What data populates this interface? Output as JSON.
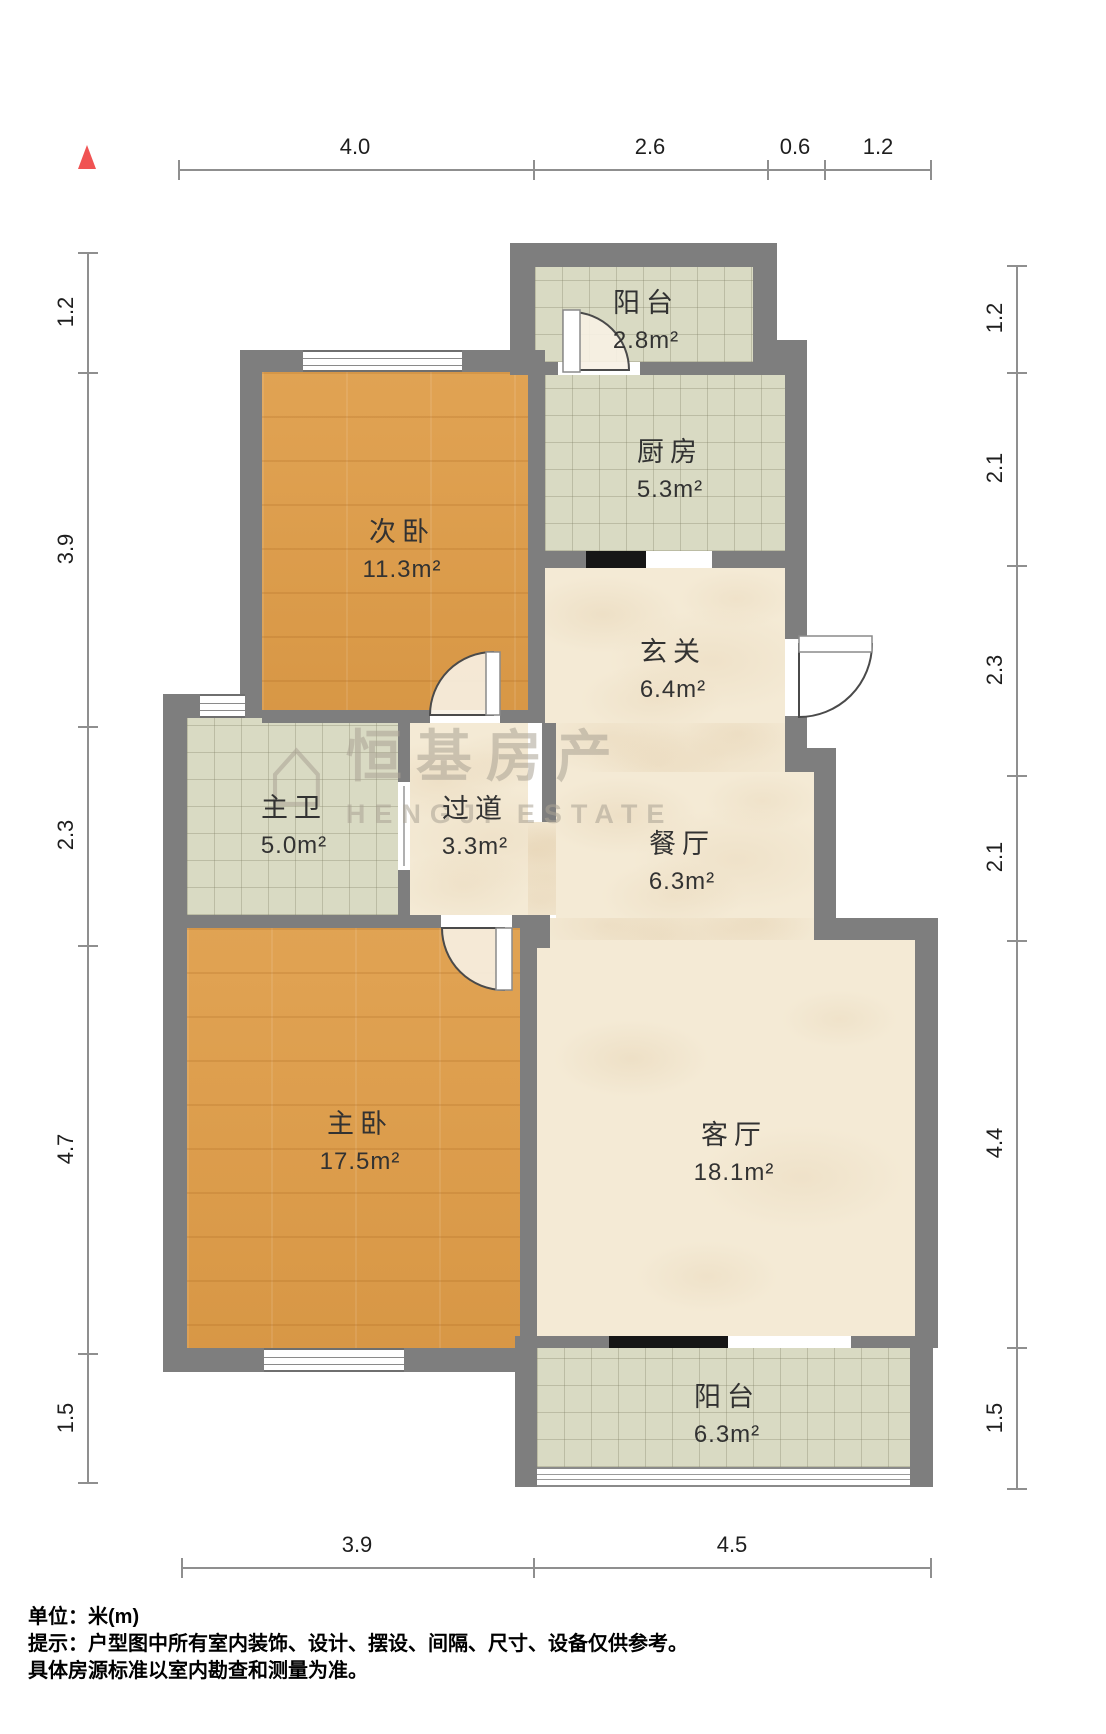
{
  "rooms": [
    {
      "id": "balcony-top",
      "name": "阳台",
      "area": "2.8m²"
    },
    {
      "id": "kitchen",
      "name": "厨房",
      "area": "5.3m²"
    },
    {
      "id": "bedroom-second",
      "name": "次卧",
      "area": "11.3m²"
    },
    {
      "id": "entry",
      "name": "玄关",
      "area": "6.4m²"
    },
    {
      "id": "bathroom-master",
      "name": "主卫",
      "area": "5.0m²"
    },
    {
      "id": "hallway",
      "name": "过道",
      "area": "3.3m²"
    },
    {
      "id": "dining",
      "name": "餐厅",
      "area": "6.3m²"
    },
    {
      "id": "bedroom-master",
      "name": "主卧",
      "area": "17.5m²"
    },
    {
      "id": "living",
      "name": "客厅",
      "area": "18.1m²"
    },
    {
      "id": "balcony-bottom",
      "name": "阳台",
      "area": "6.3m²"
    }
  ],
  "dimensions": {
    "top": [
      "4.0",
      "2.6",
      "0.6",
      "1.2"
    ],
    "bottom": [
      "3.9",
      "4.5"
    ],
    "left": [
      "1.2",
      "3.9",
      "2.3",
      "4.7",
      "1.5"
    ],
    "right": [
      "1.2",
      "2.1",
      "2.3",
      "2.1",
      "4.4",
      "1.5"
    ]
  },
  "watermark": {
    "cn": "恒基房产",
    "en": "HENGJI ESTATE",
    "logo": "⌂"
  },
  "footer": {
    "line1": "单位：米(m)",
    "line2": "提示：户型图中所有室内装饰、设计、摆设、间隔、尺寸、设备仅供参考。",
    "line3": "具体房源标准以室内勘查和测量为准。"
  }
}
